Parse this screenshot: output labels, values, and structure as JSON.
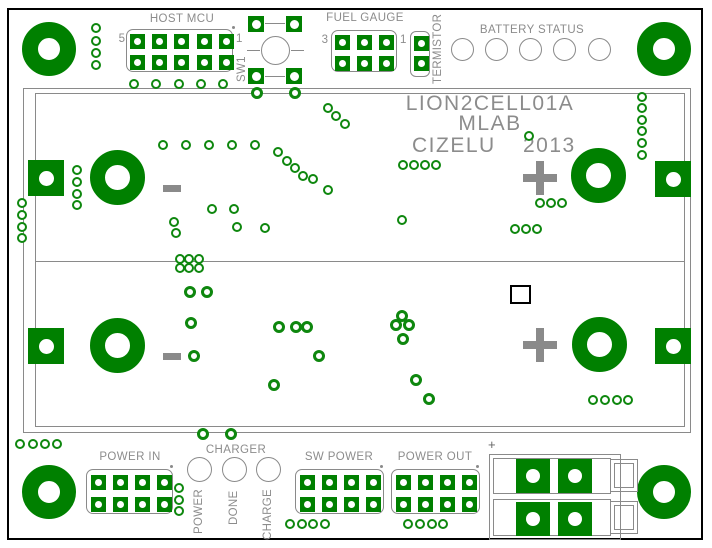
{
  "title": {
    "line1": "LION2CELL01A",
    "line2": "MLAB",
    "line3_left": "CIZELU",
    "line3_right": "2013"
  },
  "colors": {
    "copper_green": "#008000",
    "via_green": "#0e870e",
    "silkscreen_gray": "#8c8c8c",
    "frame_black": "#000000"
  },
  "connectors": {
    "host_mcu": {
      "label": "HOST MCU",
      "pin_first": "5",
      "pin_last": "1",
      "cols": 5,
      "rows": 2
    },
    "sw1": {
      "label": "SW1"
    },
    "fuel_gauge": {
      "label": "FUEL GAUGE",
      "pin_first": "3",
      "pin_last": "1",
      "cols": 3,
      "rows": 2
    },
    "termistor": {
      "label": "TERMISTOR",
      "pins": 2
    },
    "battery_status": {
      "label": "BATTERY STATUS",
      "led_count": 5
    },
    "power_in": {
      "label": "POWER IN",
      "cols": 4,
      "rows": 2
    },
    "charger": {
      "label": "CHARGER",
      "leds": [
        "POWER",
        "DONE",
        "CHARGE"
      ]
    },
    "sw_power": {
      "label": "SW POWER",
      "cols": 4,
      "rows": 2
    },
    "power_out": {
      "label": "POWER OUT",
      "cols": 4,
      "rows": 2
    },
    "battery_terminal": {
      "polarity_label": "+"
    }
  },
  "vias": {
    "small": [
      [
        96,
        28
      ],
      [
        96,
        41
      ],
      [
        96,
        53
      ],
      [
        96,
        65
      ],
      [
        134,
        84
      ],
      [
        156,
        84
      ],
      [
        179,
        84
      ],
      [
        201,
        84
      ],
      [
        223,
        84
      ],
      [
        328,
        108
      ],
      [
        336,
        116
      ],
      [
        345,
        124
      ],
      [
        642,
        97
      ],
      [
        642,
        108
      ],
      [
        642,
        120
      ],
      [
        642,
        131
      ],
      [
        642,
        143
      ],
      [
        642,
        155
      ],
      [
        529,
        136
      ],
      [
        403,
        165
      ],
      [
        414,
        165
      ],
      [
        425,
        165
      ],
      [
        436,
        165
      ],
      [
        163,
        145
      ],
      [
        186,
        145
      ],
      [
        209,
        145
      ],
      [
        232,
        145
      ],
      [
        255,
        145
      ],
      [
        278,
        152
      ],
      [
        287,
        161
      ],
      [
        295,
        168
      ],
      [
        303,
        176
      ],
      [
        313,
        179
      ],
      [
        328,
        190
      ],
      [
        212,
        209
      ],
      [
        234,
        209
      ],
      [
        174,
        222
      ],
      [
        176,
        233
      ],
      [
        237,
        227
      ],
      [
        265,
        228
      ],
      [
        402,
        220
      ],
      [
        540,
        203
      ],
      [
        551,
        203
      ],
      [
        562,
        203
      ],
      [
        515,
        229
      ],
      [
        526,
        229
      ],
      [
        537,
        229
      ],
      [
        180,
        259
      ],
      [
        189,
        259
      ],
      [
        199,
        259
      ],
      [
        180,
        268
      ],
      [
        189,
        268
      ],
      [
        199,
        268
      ],
      [
        22,
        203
      ],
      [
        22,
        215
      ],
      [
        22,
        227
      ],
      [
        22,
        238
      ],
      [
        77,
        170
      ],
      [
        77,
        182
      ],
      [
        77,
        194
      ],
      [
        77,
        205
      ],
      [
        593,
        400
      ],
      [
        605,
        400
      ],
      [
        617,
        400
      ],
      [
        628,
        400
      ],
      [
        20,
        444
      ],
      [
        33,
        444
      ],
      [
        45,
        444
      ],
      [
        57,
        444
      ],
      [
        179,
        488
      ],
      [
        179,
        500
      ],
      [
        179,
        511
      ],
      [
        290,
        524
      ],
      [
        302,
        524
      ],
      [
        313,
        524
      ],
      [
        325,
        524
      ],
      [
        408,
        524
      ],
      [
        420,
        524
      ],
      [
        432,
        524
      ],
      [
        443,
        524
      ]
    ],
    "medium": [
      [
        257,
        93
      ],
      [
        295,
        93
      ],
      [
        190,
        292
      ],
      [
        207,
        292
      ],
      [
        191,
        323
      ],
      [
        279,
        327
      ],
      [
        296,
        327
      ],
      [
        307,
        327
      ],
      [
        194,
        356
      ],
      [
        319,
        356
      ],
      [
        274,
        385
      ],
      [
        402,
        316
      ],
      [
        396,
        325
      ],
      [
        409,
        325
      ],
      [
        403,
        339
      ],
      [
        416,
        380
      ],
      [
        429,
        399
      ],
      [
        203,
        434
      ],
      [
        231,
        434
      ]
    ]
  }
}
